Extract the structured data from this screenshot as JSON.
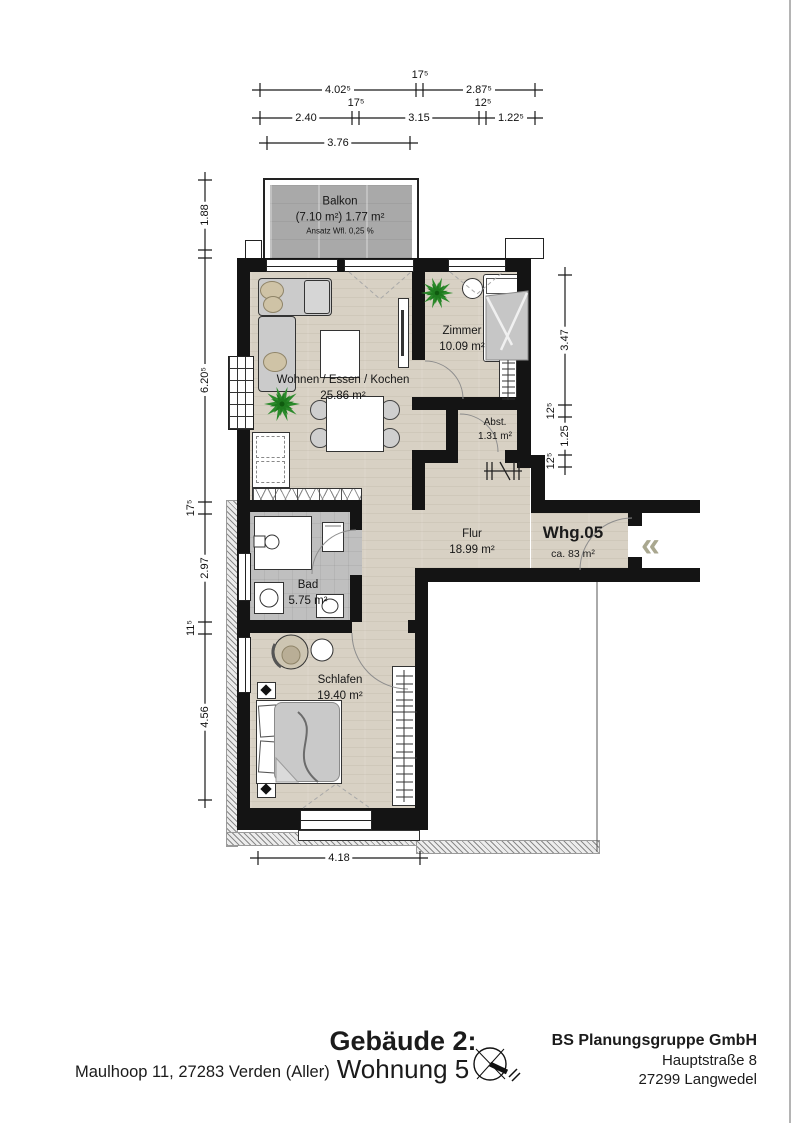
{
  "colors": {
    "wall": "#141414",
    "floor_wood": "#d8d1c4",
    "floor_bad": "#bfbfbf",
    "balcony": "#a9a9a9",
    "plant_green": "#2b8a2b",
    "entry_chevron": "#a9a78f"
  },
  "balcony": {
    "name": "Balkon",
    "area": "(7.10 m²) 1.77 m²",
    "note": "Ansatz Wfl. 0,25 %"
  },
  "rooms": {
    "wohnen": {
      "name": "Wohnen / Essen / Kochen",
      "area": "25.86 m²"
    },
    "zimmer": {
      "name": "Zimmer",
      "area": "10.09 m²"
    },
    "abst": {
      "name": "Abst.",
      "area": "1.31 m²"
    },
    "flur": {
      "name": "Flur",
      "area": "18.99 m²"
    },
    "bad": {
      "name": "Bad",
      "area": "5.75 m²"
    },
    "schlafen": {
      "name": "Schlafen",
      "area": "19.40 m²"
    }
  },
  "apartment": {
    "id": "Whg.05",
    "area": "ca. 83 m²",
    "entry_symbol": "«"
  },
  "dims": {
    "top1": {
      "a": "4.02⁵",
      "mid": "17⁵",
      "b": "2.87⁵"
    },
    "top2": {
      "a": "2.40",
      "mid1": "17⁵",
      "b": "3.15",
      "mid2": "12⁵",
      "c": "1.22⁵"
    },
    "top3": {
      "a": "3.76"
    },
    "left": {
      "a": "1.88",
      "b": "6.20⁵",
      "c": "17⁵",
      "d": "2.97",
      "e": "11⁵",
      "f": "4.56"
    },
    "right": {
      "a": "3.47",
      "b": "12⁵",
      "c": "1.25",
      "d": "12⁵"
    },
    "bottom": {
      "a": "4.18"
    }
  },
  "titleblock": {
    "address": "Maulhoop 11, 27283 Verden (Aller)",
    "building": "Gebäude 2:",
    "unit": "Wohnung 5",
    "company": "BS Planungsgruppe GmbH",
    "street": "Hauptstraße 8",
    "city": "27299 Langwedel"
  }
}
